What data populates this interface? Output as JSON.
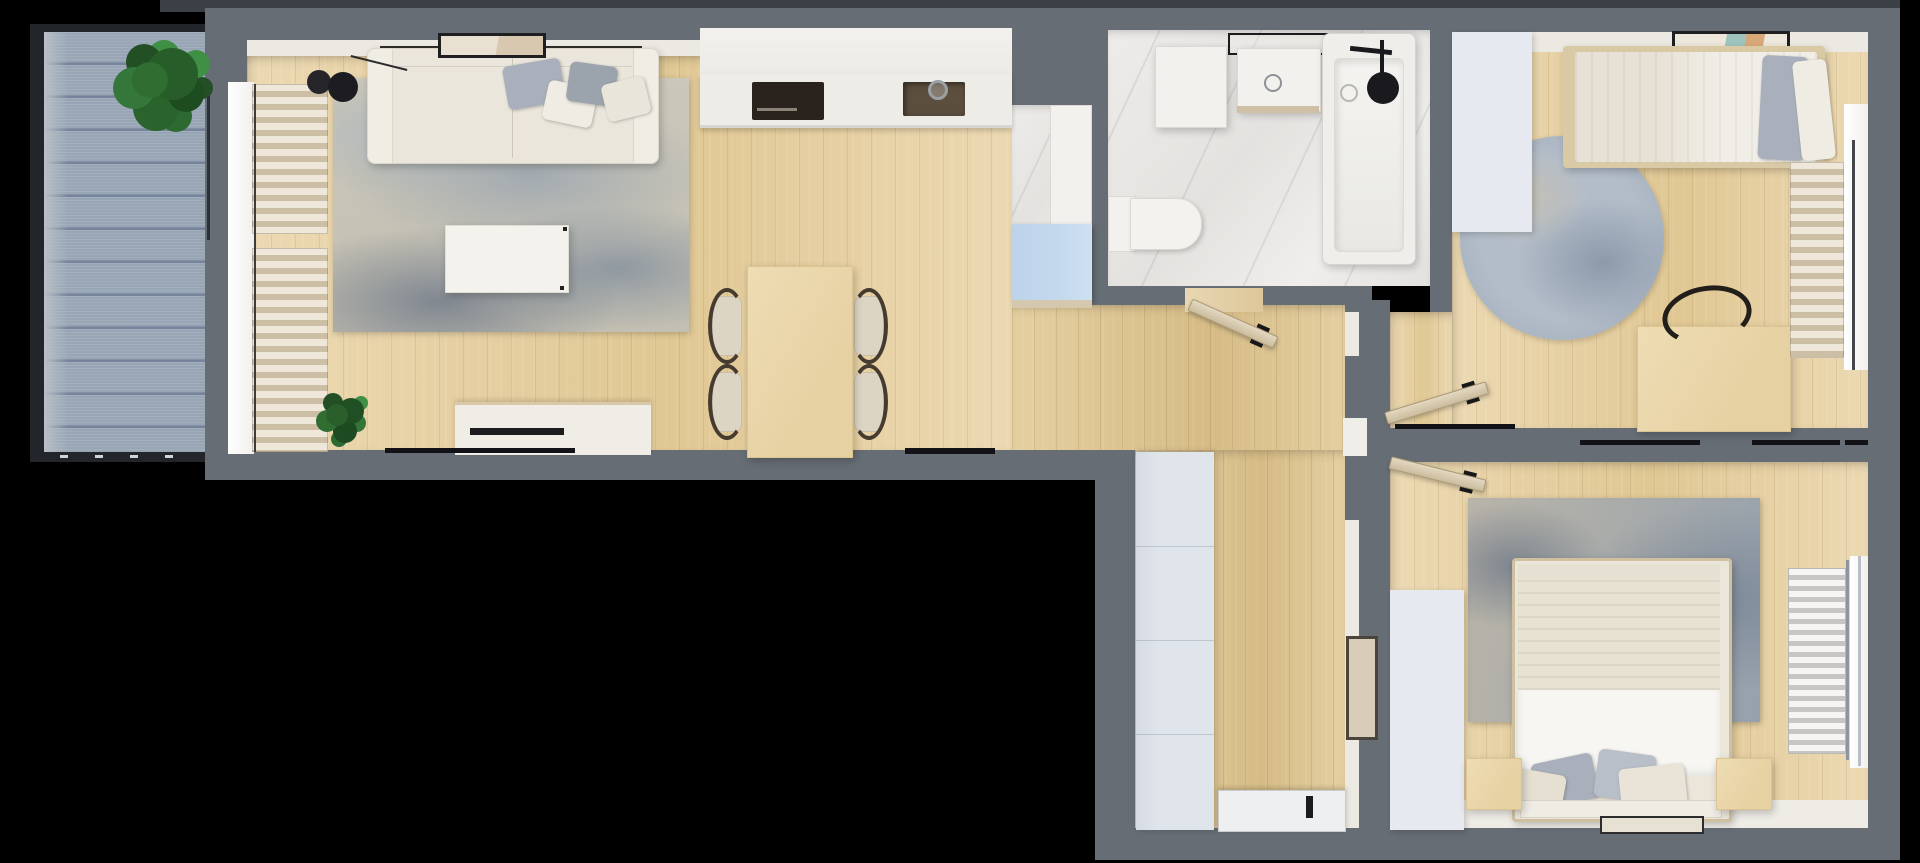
{
  "scene": {
    "type": "apartment-floor-plan-3d-top-view",
    "canvas": {
      "width": 1920,
      "height": 863
    }
  },
  "palette": {
    "wall": "#666d75",
    "wallDark": "#3b4046",
    "wallFace": "#ece9e2",
    "woodA": "#ecd9b2",
    "woodB": "#e0c793",
    "woodHallA": "#e4cfa0",
    "woodHallB": "#d6bb85",
    "deckBase": "#97a5b5",
    "deckLine": "#76859b",
    "deckLight": "#b9bfc7",
    "deckFrame": "#22262b",
    "marbleA": "#edecea",
    "marbleB": "#e4e2df",
    "cream": "#eae6dc",
    "creamDark": "#d8d2c4",
    "white1": "#f2f1ee",
    "lavender": "#e0e4eb",
    "lavender2": "#e6e9ef",
    "blueCab": "#c4d9ed",
    "slatA": "#efe8da",
    "slatB": "#cdbfa5",
    "glow": "#f7f6f3",
    "furnWood": "#eedcb4",
    "furnWoodEdge": "#dcc392",
    "doorLeaf": "#dbcfb8",
    "doorEdge": "#a79876",
    "black": "#17171a",
    "metal": "#8f959e",
    "greenA": "#2f6d31",
    "greenB": "#1e4c21",
    "greenC": "#3f8f44",
    "grayPillow": "#a9b0bb",
    "radA": "#f6f5f3",
    "radB": "#c8c6c2"
  },
  "rooms": [
    {
      "id": "balcony",
      "label": "balcony",
      "features": [
        "blue-gray wood deck",
        "potted plant",
        "dark railing frame"
      ]
    },
    {
      "id": "living-dining-kitchen",
      "label": "open living / dining / kitchen",
      "features": [
        "three-seat sofa with pillows",
        "black floor lamp",
        "wall art",
        "distressed blue area rug",
        "white coffee table",
        "tv stand",
        "decorative plant",
        "window with beige curtain slats",
        "kitchen counter run",
        "black induction cooktop",
        "kitchen sink",
        "wood dining table",
        "four chairs with dark curved arms"
      ]
    },
    {
      "id": "entry-closet",
      "label": "entry closet niche",
      "features": [
        "marble floor",
        "tall white cabinet",
        "light blue cabinet"
      ]
    },
    {
      "id": "bathroom",
      "label": "bathroom",
      "features": [
        "marble tile floor",
        "washing machine block",
        "vanity sink with black framed shelf",
        "bathtub with black shower head",
        "toilet"
      ]
    },
    {
      "id": "hallway",
      "label": "hallway",
      "features": [
        "tall white wardrobe",
        "entry door with black handle",
        "framed wall mirror",
        "open interior doors"
      ]
    },
    {
      "id": "bedroom-top",
      "label": "top-right bedroom",
      "features": [
        "single bed with gray pillow",
        "wall art",
        "round blue rug",
        "wood desk",
        "black curved desk chair",
        "window with beige curtain slats",
        "tall wardrobe",
        "open door"
      ]
    },
    {
      "id": "bedroom-bottom",
      "label": "bottom-right bedroom",
      "features": [
        "double bed with white duvet and pillows",
        "foot bench with tray",
        "two wood nightstands",
        "distressed blue area rug",
        "towel radiator",
        "window",
        "tall wardrobe",
        "open door"
      ]
    }
  ]
}
